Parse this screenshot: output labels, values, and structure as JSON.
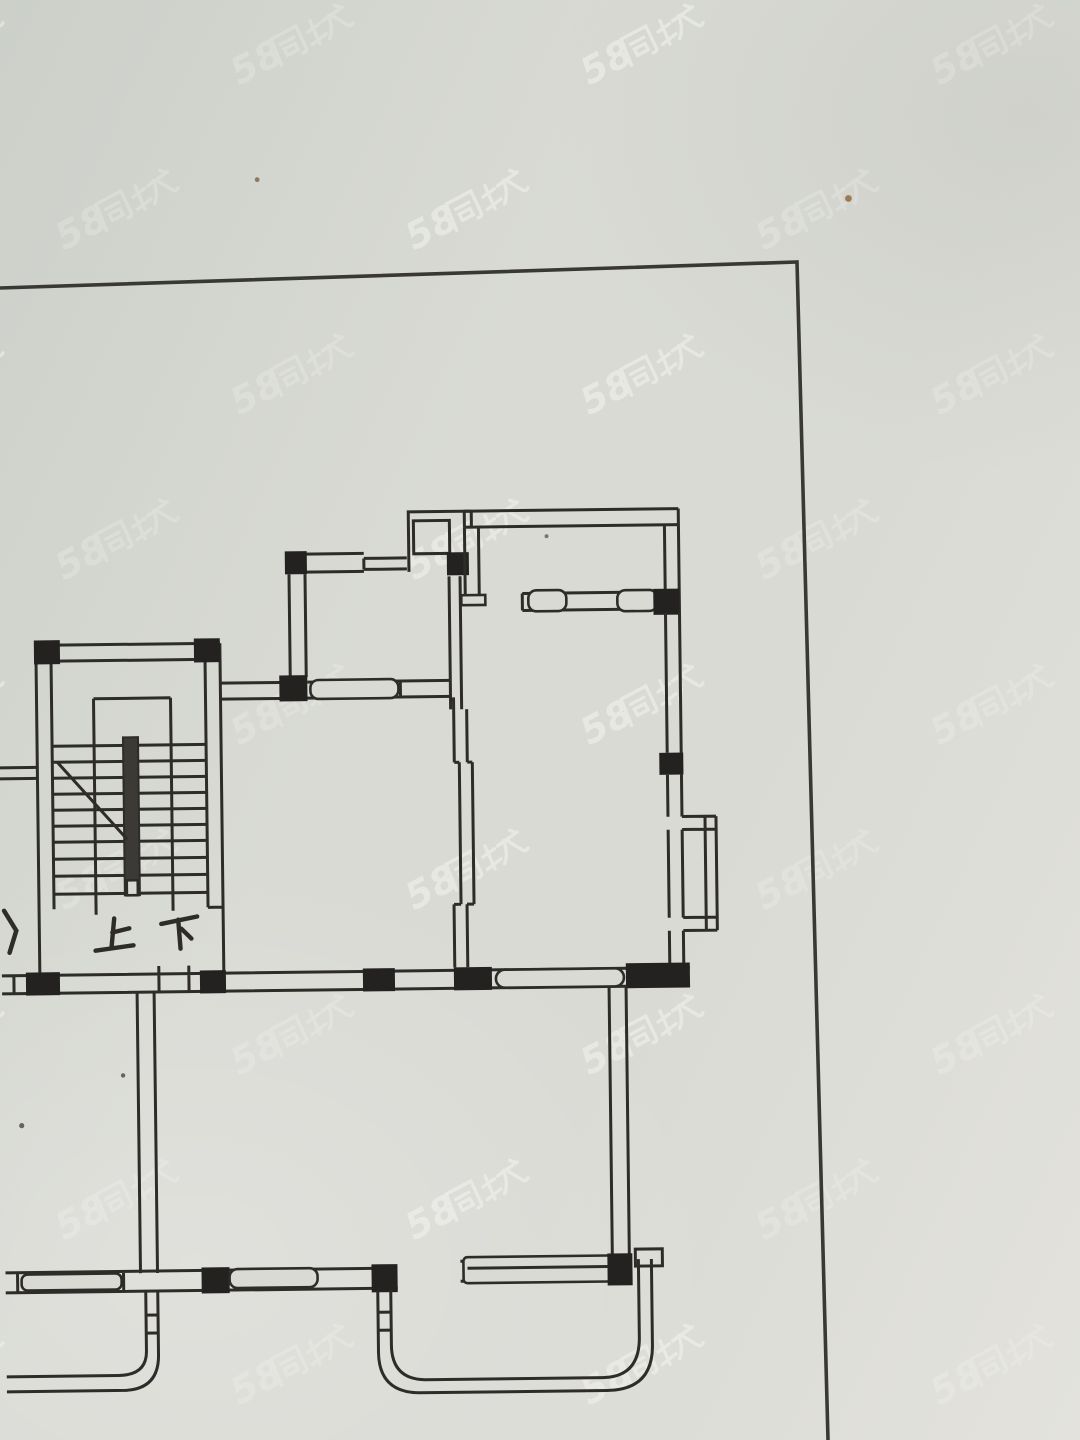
{
  "meta": {
    "description": "Photograph of a hand-drawn apartment floor plan on paper (real-estate listing photo)",
    "content_type": "floor-plan-photo"
  },
  "plan": {
    "labels": {
      "up": "上",
      "down": "下"
    },
    "features": {
      "staircase": "staircase with treads, center rail and break line",
      "rooms": "upper-left room, upper-right room, middle-right room with bay window, two lower rooms, two lower balconies"
    }
  },
  "watermark": {
    "text": "58同城",
    "latin": "58",
    "cjk": "同城",
    "grid": {
      "cols": 4,
      "rows": 9,
      "dx": 350,
      "dy": 165,
      "stagger": 175,
      "x0": -60,
      "y0": 45,
      "rotation": -28
    },
    "opacity_strong": 0.42,
    "opacity_weak": 0.22
  },
  "colors": {
    "paper": "#d9dad4",
    "paper_light": "#e3e2dc",
    "paper_dark": "#ccd0c9",
    "ink": "#2e2c29",
    "block": "#242220",
    "border": "#3a3835",
    "watermark": "#fbfbf8",
    "speck": "#96744f"
  }
}
